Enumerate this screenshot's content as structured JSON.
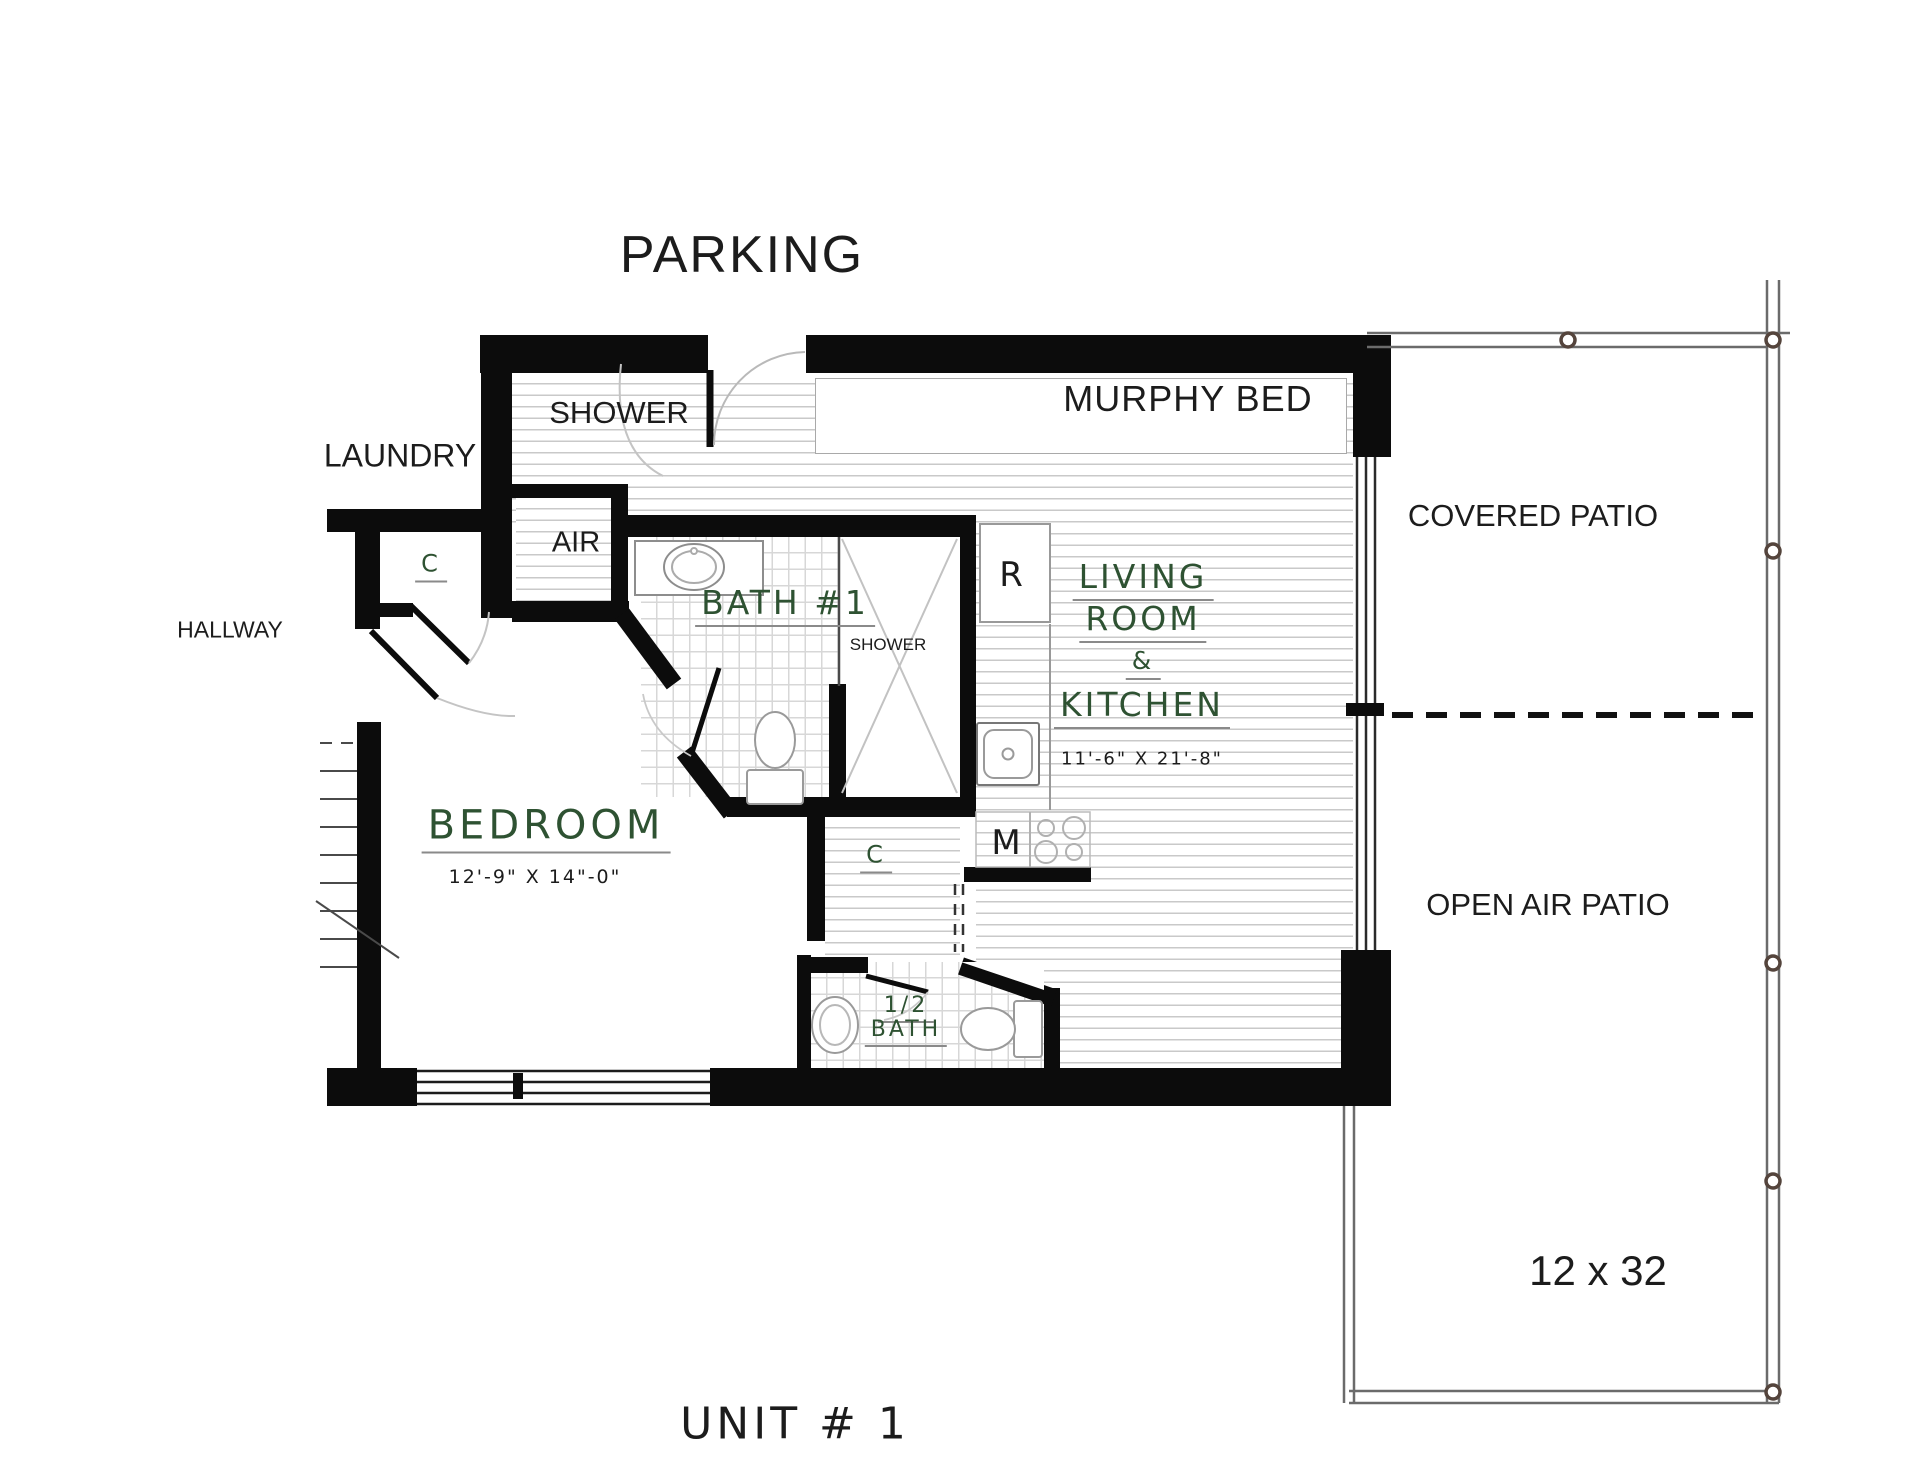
{
  "labels": {
    "parking": "PARKING",
    "laundry": "LAUNDRY",
    "shower_room": "SHOWER",
    "air": "AIR",
    "hallway": "HALLWAY",
    "closet_upper": "C",
    "closet_lower": "C",
    "bath1": "BATH #1",
    "bath1_shower": "SHOWER",
    "bedroom": "BEDROOM",
    "murphy_bed": "MURPHY BED",
    "living_line1": "LIVING",
    "living_line2": "ROOM",
    "living_line3": "&",
    "living_line4": "KITCHEN",
    "half_bath_line1": "1/2",
    "half_bath_line2": "BATH",
    "covered_patio": "COVERED PATIO",
    "open_air_patio": "OPEN AIR PATIO",
    "unit": "UNIT # 1",
    "fridge": "R",
    "microwave": "M"
  },
  "dimensions": {
    "bedroom": "12'-9\" X 14\"-0\"",
    "living_kitchen": "11'-6\" X 21'-8\"",
    "patio": "12 x 32"
  },
  "colors": {
    "wall": "#0c0c0c",
    "label_green": "#2e5232",
    "label_black": "#1c1c1c",
    "floor_line": "#c9c9c9",
    "patio_rail": "#6b6b6b"
  }
}
